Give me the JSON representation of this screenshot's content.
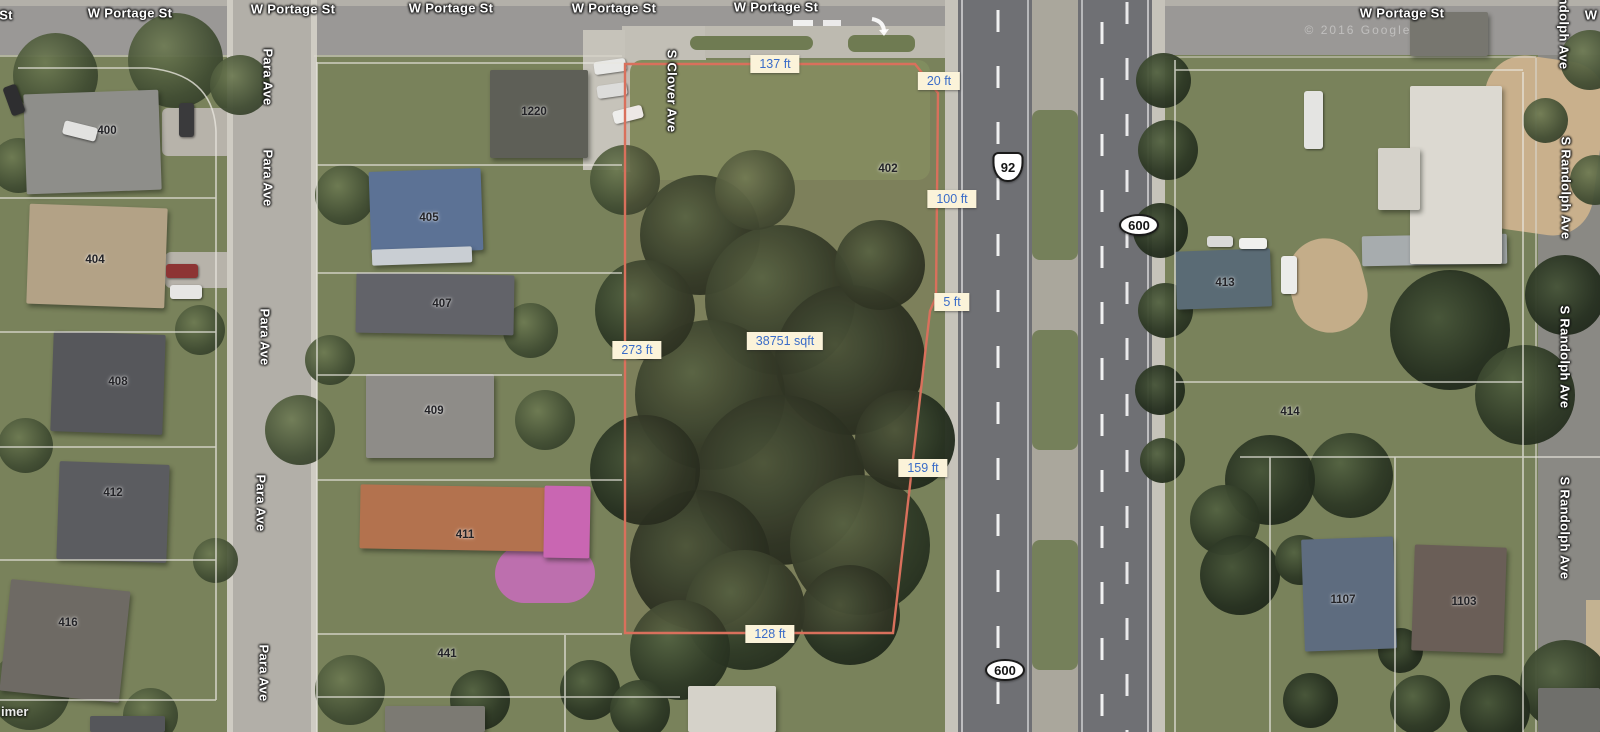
{
  "map": {
    "attribution_partial": "imer",
    "copyright": "© 2016 Google",
    "street_labels": [
      {
        "text": "St",
        "x": 6,
        "y": 15,
        "orientation": "h"
      },
      {
        "text": "W Portage St",
        "x": 130,
        "y": 13,
        "orientation": "h"
      },
      {
        "text": "W Portage St",
        "x": 293,
        "y": 9,
        "orientation": "h"
      },
      {
        "text": "W Portage St",
        "x": 451,
        "y": 8,
        "orientation": "h"
      },
      {
        "text": "W Portage St",
        "x": 614,
        "y": 8,
        "orientation": "h"
      },
      {
        "text": "W Portage St",
        "x": 776,
        "y": 7,
        "orientation": "h"
      },
      {
        "text": "W Portage St",
        "x": 1402,
        "y": 13,
        "orientation": "h"
      },
      {
        "text": "W",
        "x": 1591,
        "y": 15,
        "orientation": "h"
      },
      {
        "text": "Para Ave",
        "x": 268,
        "y": 77,
        "orientation": "v"
      },
      {
        "text": "Para Ave",
        "x": 268,
        "y": 178,
        "orientation": "v"
      },
      {
        "text": "Para Ave",
        "x": 265,
        "y": 337,
        "orientation": "v"
      },
      {
        "text": "Para Ave",
        "x": 261,
        "y": 503,
        "orientation": "v"
      },
      {
        "text": "Para Ave",
        "x": 264,
        "y": 673,
        "orientation": "v"
      },
      {
        "text": "S Clover Ave",
        "x": 672,
        "y": 91,
        "orientation": "v"
      },
      {
        "text": "ndolph Ave",
        "x": 1564,
        "y": 33,
        "orientation": "v"
      },
      {
        "text": "S Randolph Ave",
        "x": 1566,
        "y": 188,
        "orientation": "v"
      },
      {
        "text": "S Randolph Ave",
        "x": 1565,
        "y": 357,
        "orientation": "v"
      },
      {
        "text": "S Randolph Ave",
        "x": 1565,
        "y": 528,
        "orientation": "v"
      }
    ],
    "route_shields": [
      {
        "text": "92",
        "type": "us",
        "x": 1008,
        "y": 167
      },
      {
        "text": "600",
        "type": "oval",
        "x": 1139,
        "y": 225
      },
      {
        "text": "600",
        "type": "oval",
        "x": 1005,
        "y": 670
      }
    ],
    "parcel": {
      "outline_color": "#D9705C",
      "area_label": "38751 sqft",
      "measurements": [
        {
          "text": "137 ft",
          "x": 775,
          "y": 64
        },
        {
          "text": "20 ft",
          "x": 939,
          "y": 81
        },
        {
          "text": "100 ft",
          "x": 952,
          "y": 199
        },
        {
          "text": "5 ft",
          "x": 952,
          "y": 302
        },
        {
          "text": "159 ft",
          "x": 923,
          "y": 468
        },
        {
          "text": "128 ft",
          "x": 770,
          "y": 634
        },
        {
          "text": "273 ft",
          "x": 637,
          "y": 350
        },
        {
          "text": "38751 sqft",
          "x": 785,
          "y": 341
        }
      ]
    },
    "house_numbers": [
      {
        "text": "400",
        "x": 107,
        "y": 131
      },
      {
        "text": "404",
        "x": 95,
        "y": 260
      },
      {
        "text": "405",
        "x": 429,
        "y": 218
      },
      {
        "text": "407",
        "x": 442,
        "y": 304
      },
      {
        "text": "408",
        "x": 118,
        "y": 382
      },
      {
        "text": "409",
        "x": 434,
        "y": 411
      },
      {
        "text": "411",
        "x": 465,
        "y": 535
      },
      {
        "text": "412",
        "x": 113,
        "y": 493
      },
      {
        "text": "416",
        "x": 68,
        "y": 623
      },
      {
        "text": "441",
        "x": 447,
        "y": 654
      },
      {
        "text": "402",
        "x": 888,
        "y": 169
      },
      {
        "text": "1220",
        "x": 534,
        "y": 112
      },
      {
        "text": "413",
        "x": 1225,
        "y": 283
      },
      {
        "text": "414",
        "x": 1290,
        "y": 412
      },
      {
        "text": "1107",
        "x": 1343,
        "y": 600
      },
      {
        "text": "1103",
        "x": 1464,
        "y": 602
      }
    ],
    "colors": {
      "parcel_outline": "#D9705C",
      "parcel_boundary_lines": "#E9E7DF",
      "measurement_bg": "#FBF3D9",
      "measurement_text": "#3A6CC8",
      "street_label_text": "#FFFFFF"
    }
  }
}
